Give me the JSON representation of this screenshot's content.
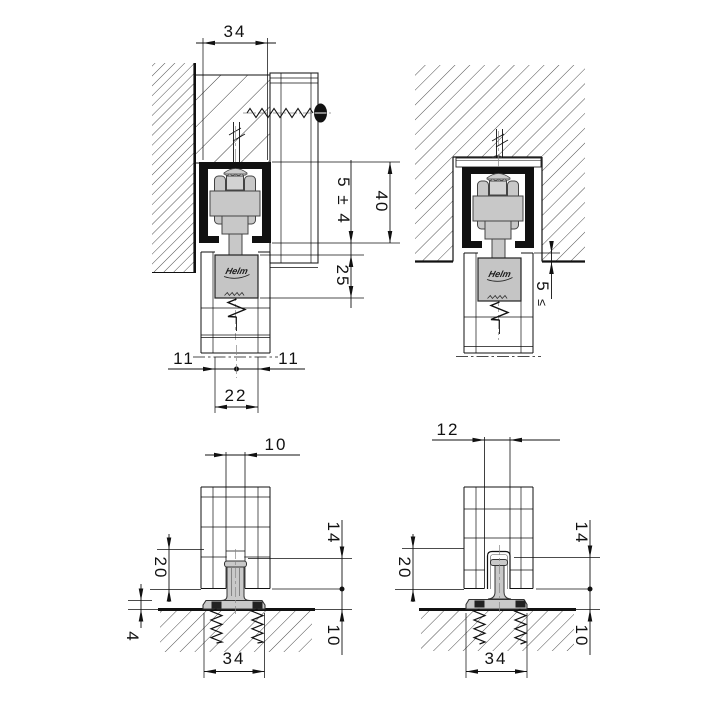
{
  "drawing": {
    "brand_logo": "Helm",
    "top_left": {
      "dims": {
        "track_width": "34",
        "hanger_clearance": "5 ± 4",
        "track_height": "40",
        "bracket_depth": "25",
        "offset_left": "11",
        "offset_right": "11",
        "bracket_width": "22"
      }
    },
    "top_right": {
      "dims": {
        "clearance_value": "5",
        "clearance_relation": "≤"
      }
    },
    "bottom_left": {
      "dims": {
        "groove_width": "10",
        "groove_depth": "20",
        "engagement": "14",
        "base_height": "4",
        "floor_clearance": "10",
        "base_width": "34"
      }
    },
    "bottom_right": {
      "dims": {
        "groove_width": "12",
        "groove_depth": "20",
        "engagement": "14",
        "floor_clearance": "10",
        "base_width": "34"
      }
    }
  }
}
